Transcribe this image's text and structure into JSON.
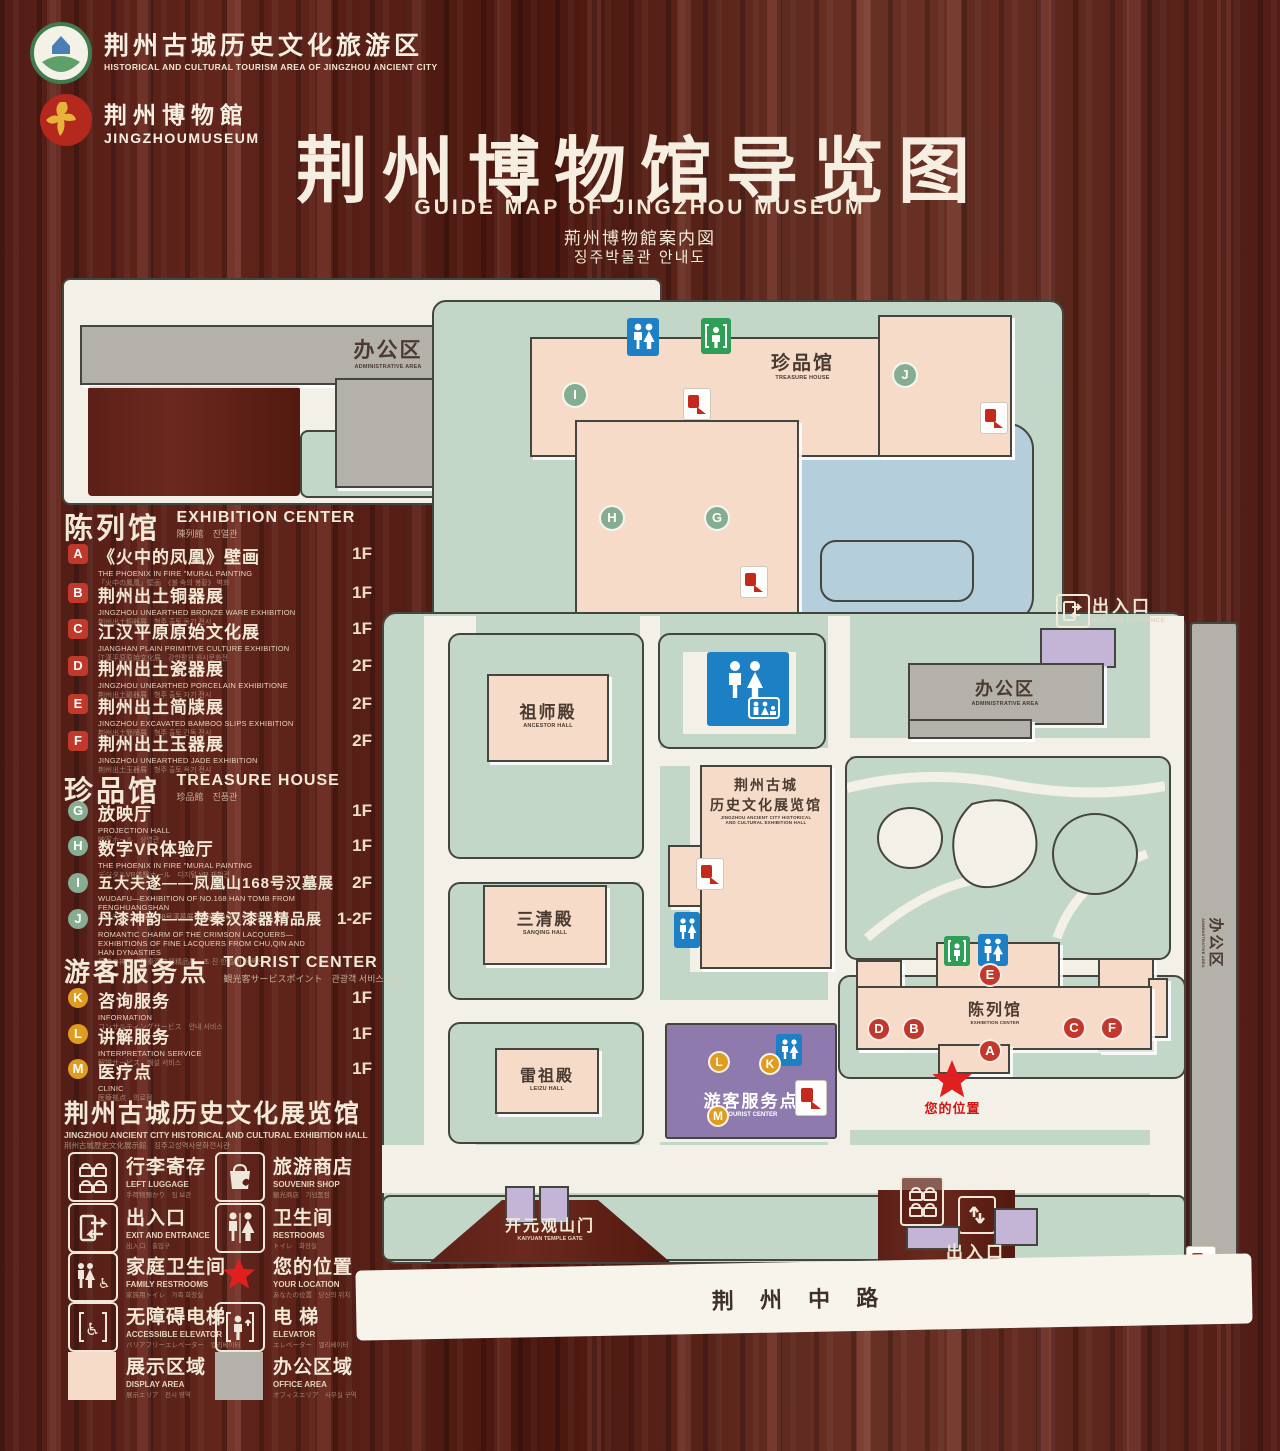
{
  "header": {
    "logo1": {
      "zh": "荆州古城历史文化旅游区",
      "en": "HISTORICAL AND CULTURAL TOURISM AREA OF JINGZHOU ANCIENT CITY"
    },
    "logo2": {
      "zh": "荆州博物館",
      "en": "JINGZHOUMUSEUM"
    },
    "title": "荆州博物馆导览图",
    "subtitle_en": "GUIDE MAP OF JINGZHOU MUSEUM",
    "subtitle_ja": "荊州博物館案内図",
    "subtitle_ko": "징주박물관 안내도"
  },
  "legend": {
    "sections": [
      {
        "title_zh": "陈列馆",
        "title_en": "EXHIBITION CENTER",
        "subtitle": "陳列館　진열관",
        "items": [
          {
            "letter": "A",
            "zh": "《火中的凤凰》壁画",
            "en": "THE PHOENIX IN FIRE \"MURAL PAINTING",
            "sub": "「火中の鳳凰」壁画　《불 속의 봉황》 벽화",
            "floor": "1F"
          },
          {
            "letter": "B",
            "zh": "荆州出土铜器展",
            "en": "JINGZHOU UNEARTHED BRONZE WARE EXHIBITION",
            "sub": "荆州出土銅器展　형주 출토 동기 전시",
            "floor": "1F"
          },
          {
            "letter": "C",
            "zh": "江汉平原原始文化展",
            "en": "JIANGHAN PLAIN PRIMITIVE CULTURE EXHIBITION",
            "sub": "江漢平原原始文化展　강한평원 원시문화전",
            "floor": "1F"
          },
          {
            "letter": "D",
            "zh": "荆州出土瓷器展",
            "en": "JINGZHOU UNEARTHED PORCELAIN EXHIBITIONE",
            "sub": "荆州出土磁器展　형주 출토 자기 전시",
            "floor": "2F"
          },
          {
            "letter": "E",
            "zh": "荆州出土简牍展",
            "en": "JINGZHOU EXCAVATED BAMBOO SLIPS EXHIBITION",
            "sub": "荆州出土簡牘展　형주 출토 간독 전시",
            "floor": "2F"
          },
          {
            "letter": "F",
            "zh": "荆州出土玉器展",
            "en": "JINGZHOU UNEARTHED JADE EXHIBITION",
            "sub": "荆州出土玉器展　형주 출토 옥기 전시",
            "floor": "2F"
          }
        ]
      },
      {
        "title_zh": "珍品馆",
        "title_en": "TREASURE HOUSE",
        "subtitle": "珍品館　진품관",
        "items": [
          {
            "letter": "G",
            "zh": "放映厅",
            "en": "PROJECTION HALL",
            "sub": "映写ホール　상영관",
            "floor": "1F"
          },
          {
            "letter": "H",
            "zh": "数字VR体验厅",
            "en": "THE PHOENIX IN FIRE \"MURAL PAINTING",
            "sub": "デジタルVR体験ホール　디지털 VR 체험관",
            "floor": "1F"
          },
          {
            "letter": "I",
            "zh": "五大夫遂——凤凰山168号汉墓展",
            "en": "WUDAFU—EXHIBITION OF NO.168 HAN TOMB FROM FENGHUANGSHAN",
            "sub": "五大夫遂—鳳凰山168号漢墓展　봉황산 168호 한묘전",
            "floor": "2F"
          },
          {
            "letter": "J",
            "zh": "丹漆神韵——楚秦汉漆器精品展",
            "en": "ROMANTIC CHARM OF THE CRIMSON LACQUERS— EXHIBITIONS OF FINE LACQUERS FROM CHU,QIN AND HAN DYNASTIES",
            "sub": "丹漆の神韻—楚秦漢漆器精品展　초·진·한 칠기 정품전",
            "floor": "1-2F"
          }
        ]
      },
      {
        "title_zh": "游客服务点",
        "title_en": "TOURIST CENTER",
        "subtitle": "観光客サービスポイント　관광객 서비스 지점",
        "items": [
          {
            "letter": "K",
            "zh": "咨询服务",
            "en": "INFORMATION",
            "sub": "コンサルティングサービス　안내 서비스",
            "floor": "1F"
          },
          {
            "letter": "L",
            "zh": "讲解服务",
            "en": "INTERPRETATION SERVICE",
            "sub": "解説サービス　해설 서비스",
            "floor": "1F"
          },
          {
            "letter": "M",
            "zh": "医疗点",
            "en": "CLINIC",
            "sub": "医療拠点　의료점",
            "floor": "1F"
          }
        ]
      }
    ],
    "hall_note": {
      "zh": "荆州古城历史文化展览馆",
      "en": "JINGZHOU ANCIENT CITY HISTORICAL AND CULTURAL EXHIBITION HALL",
      "sub": "荆州古城歴史文化展示館　징주고성역사문화전시관"
    },
    "icons": [
      {
        "zh": "行李寄存",
        "en": "LEFT LUGGAGE",
        "sub": "手荷物預かり　짐 보관"
      },
      {
        "zh": "旅游商店",
        "en": "SOUVENIR SHOP",
        "sub": "観光商店　기념품점"
      },
      {
        "zh": "出入口",
        "en": "EXIT AND ENTRANCE",
        "sub": "出入口　출입구"
      },
      {
        "zh": "卫生间",
        "en": "RESTROOMS",
        "sub": "トイレ　화장실"
      },
      {
        "zh": "家庭卫生间",
        "en": "FAMILY RESTROOMS",
        "sub": "家族用トイレ　가족 화장실"
      },
      {
        "zh": "您的位置",
        "en": "YOUR LOCATION",
        "sub": "あなたの位置　당신의 위치"
      },
      {
        "zh": "无障碍电梯",
        "en": "ACCESSIBLE ELEVATOR",
        "sub": "バリアフリーエレベーター　엘리베이터"
      },
      {
        "zh": "电  梯",
        "en": "ELEVATOR",
        "sub": "エレベーター　엘리베이터"
      },
      {
        "zh": "展示区域",
        "en": "DISPLAY AREA",
        "sub": "展示エリア　전시 영역"
      },
      {
        "zh": "办公区域",
        "en": "OFFICE AREA",
        "sub": "オフィスエリア　사무실 구역"
      }
    ]
  },
  "map": {
    "badges": [
      "A",
      "B",
      "C",
      "D",
      "E",
      "F",
      "G",
      "H",
      "I",
      "J",
      "K",
      "L",
      "M"
    ],
    "labels": {
      "admin_top_zh": "办公区",
      "admin_top_en": "ADMINISTRATIVE AREA",
      "treasure_zh": "珍品馆",
      "treasure_en": "TREASURE HOUSE",
      "ancestor_zh": "祖师殿",
      "ancestor_en": "ANCESTOR HALL",
      "sanqing_zh": "三清殿",
      "sanqing_en": "SANQING HALL",
      "leizu_zh": "雷祖殿",
      "leizu_en": "LEIZU HALL",
      "hallc_zh1": "荆州古城",
      "hallc_zh2": "历史文化展览馆",
      "hallc_en1": "JINGZHOU ANCIENT CITY HISTORICAL",
      "hallc_en2": "AND CULTURAL EXHIBITION HALL",
      "tourist_zh": "游客服务点",
      "tourist_en": "TOURIST CENTER",
      "excenter_zh": "陈列馆",
      "excenter_en": "EXHIBITION CENTER",
      "admin_right_zh": "办公区",
      "admin_right_en": "ADMINISTRATIVE AREA",
      "strip_zh": "办公区",
      "strip_en": "ADMINISTRATIVE AREA",
      "exit_right_zh": "出入口",
      "exit_right_en": "EXIT AND ENTRANCE",
      "exit_bottom_zh": "出入口",
      "exit_bottom_en": "EXIT AND ENTRANCE",
      "gate_zh": "开元观山门",
      "gate_en": "KAIYUAN TEMPLE GATE",
      "road": "荆 州 中 路",
      "your_location": "您的位置"
    }
  },
  "colors": {
    "wood": "#5c2018",
    "walkway": "#c3d7c9",
    "display": "#f6dbc9",
    "office": "#b4b1aa",
    "tourist": "#8e7aac",
    "lake": "#b5cedb",
    "badge_red": "#c0392b",
    "badge_green": "#86ad92",
    "badge_amber": "#e09c1f",
    "restroom_blue": "#1d7fc4",
    "elevator_green": "#2f9e57",
    "location_red": "#e01f1f"
  }
}
